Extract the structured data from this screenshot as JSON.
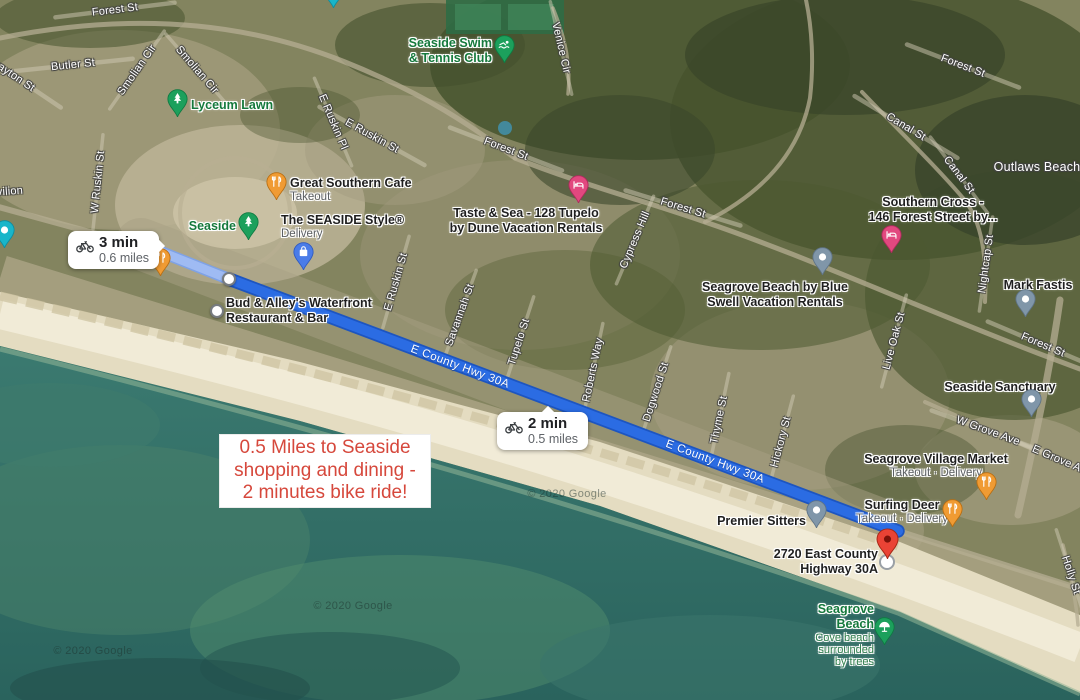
{
  "map": {
    "attribution": "© 2020 Google",
    "route": {
      "name": "E County Hwy 30A",
      "start": {
        "x": 141,
        "y": 244
      },
      "waypoint": {
        "x": 229,
        "y": 279
      },
      "end": {
        "x": 898,
        "y": 531
      },
      "labels": [
        {
          "x": 460,
          "y": 367,
          "rot": 20.5
        },
        {
          "x": 715,
          "y": 462,
          "rot": 20.5
        }
      ],
      "colors": {
        "selected": "#2B6CE3",
        "selected_casing": "#1D55C0",
        "segment": "#9FBBF3",
        "segment_casing": "#7FA2E5"
      }
    },
    "badges": [
      {
        "time": "3 min",
        "distance": "0.6 miles"
      },
      {
        "time": "2 min",
        "distance": "0.5 miles"
      }
    ],
    "annotation": {
      "lines": [
        "0.5 Miles to Seaside",
        "shopping and dining -",
        "2 minutes bike ride!"
      ]
    },
    "street_labels": [
      {
        "text": "Forest St",
        "x": 115,
        "y": 10,
        "rot": -7
      },
      {
        "text": "Butler St",
        "x": 73,
        "y": 65,
        "rot": -6
      },
      {
        "text": "Grayton St",
        "x": 11,
        "y": 74,
        "rot": 34
      },
      {
        "text": "Smolian Cir",
        "x": 137,
        "y": 70,
        "rot": -55
      },
      {
        "text": "Smolian Cir",
        "x": 197,
        "y": 70,
        "rot": 49
      },
      {
        "text": "W Ruskin St",
        "x": 98,
        "y": 182,
        "rot": -84
      },
      {
        "text": "E Ruskin Pl",
        "x": 333,
        "y": 122,
        "rot": 67
      },
      {
        "text": "E Ruskin St",
        "x": 372,
        "y": 136,
        "rot": 29
      },
      {
        "text": "E Ruskin St",
        "x": 396,
        "y": 282,
        "rot": -74
      },
      {
        "text": "Forest St",
        "x": 506,
        "y": 149,
        "rot": 21
      },
      {
        "text": "Venice Cir",
        "x": 561,
        "y": 48,
        "rot": 77
      },
      {
        "text": "Forest St",
        "x": 683,
        "y": 208,
        "rot": 17
      },
      {
        "text": "Cypress Hill",
        "x": 635,
        "y": 240,
        "rot": -67
      },
      {
        "text": "Forest St",
        "x": 963,
        "y": 66,
        "rot": 21
      },
      {
        "text": "Canal St",
        "x": 906,
        "y": 127,
        "rot": 31
      },
      {
        "text": "Canal St",
        "x": 959,
        "y": 175,
        "rot": 53
      },
      {
        "text": "Outlaws Beach",
        "x": 1037,
        "y": 167,
        "rot": 0,
        "size": 12.5,
        "noline": true
      },
      {
        "text": "Nightcap St",
        "x": 986,
        "y": 264,
        "rot": -82
      },
      {
        "text": "Live Oak St",
        "x": 894,
        "y": 341,
        "rot": -75
      },
      {
        "text": "Forest St",
        "x": 1043,
        "y": 345,
        "rot": 23
      },
      {
        "text": "Savannah St",
        "x": 460,
        "y": 315,
        "rot": -70
      },
      {
        "text": "Tupelo St",
        "x": 519,
        "y": 342,
        "rot": -72
      },
      {
        "text": "Roberts Way",
        "x": 593,
        "y": 370,
        "rot": -78
      },
      {
        "text": "Dogwood St",
        "x": 656,
        "y": 392,
        "rot": -72
      },
      {
        "text": "Thyme St",
        "x": 719,
        "y": 420,
        "rot": -78
      },
      {
        "text": "Hickory St",
        "x": 781,
        "y": 442,
        "rot": -75
      },
      {
        "text": "W Grove Ave",
        "x": 988,
        "y": 431,
        "rot": 20
      },
      {
        "text": "E Grove Ave",
        "x": 1062,
        "y": 461,
        "rot": 23
      },
      {
        "text": "Holly St",
        "x": 1071,
        "y": 575,
        "rot": 72
      },
      {
        "text": "Pavilion",
        "x": 3,
        "y": 192,
        "rot": -4,
        "noline": true
      }
    ],
    "poi_labels": [
      {
        "name": "lyceum-lawn",
        "type": "nature",
        "align": "left",
        "x": 191,
        "y": 96,
        "title_lines": [
          "Lyceum Lawn"
        ]
      },
      {
        "name": "seaside-swim-tennis-club",
        "type": "nature",
        "align": "right",
        "x": 492,
        "y": 36,
        "title_lines": [
          "Seaside Swim",
          "& Tennis Club"
        ]
      },
      {
        "name": "seaside",
        "type": "nature",
        "align": "right",
        "x": 236,
        "y": 217,
        "title_lines": [
          "Seaside"
        ]
      },
      {
        "name": "great-southern-cafe",
        "type": "business",
        "align": "left",
        "x": 290,
        "y": 176,
        "title_lines": [
          "Great Southern Cafe"
        ],
        "sub_lines": [
          "Takeout"
        ]
      },
      {
        "name": "the-seaside-style",
        "type": "business",
        "align": "left",
        "x": 281,
        "y": 213,
        "title_lines": [
          "The SEASIDE Style®"
        ],
        "sub_lines": [
          "Delivery"
        ]
      },
      {
        "name": "taste-and-sea",
        "type": "business",
        "align": "center",
        "x": 526,
        "y": 206,
        "title_lines": [
          "Taste & Sea - 128 Tupelo",
          "by Dune Vacation Rentals"
        ]
      },
      {
        "name": "bud-and-alleys",
        "type": "business",
        "align": "left",
        "x": 226,
        "y": 296,
        "title_lines": [
          "Bud & Alley's Waterfront",
          "Restaurant & Bar"
        ]
      },
      {
        "name": "southern-cross",
        "type": "business",
        "align": "center",
        "x": 933,
        "y": 195,
        "title_lines": [
          "Southern Cross -",
          "146 Forest Street by..."
        ]
      },
      {
        "name": "seagrove-by-blue-swell",
        "type": "business",
        "align": "center",
        "x": 775,
        "y": 280,
        "title_lines": [
          "Seagrove Beach by Blue",
          "Swell Vacation Rentals"
        ]
      },
      {
        "name": "mark-fastis",
        "type": "business",
        "align": "center",
        "x": 1038,
        "y": 276,
        "title_lines": [
          "Mark Fastis"
        ]
      },
      {
        "name": "seaside-sanctuary",
        "type": "business",
        "align": "center",
        "x": 1000,
        "y": 378,
        "title_lines": [
          "Seaside Sanctuary"
        ]
      },
      {
        "name": "seagrove-village-market",
        "type": "business",
        "align": "center",
        "x": 936,
        "y": 452,
        "title_lines": [
          "Seagrove Village Market"
        ],
        "sub_lines": [
          "Takeout · Delivery"
        ]
      },
      {
        "name": "surfing-deer",
        "type": "business",
        "align": "center",
        "x": 902,
        "y": 498,
        "title_lines": [
          "Surfing Deer"
        ],
        "sub_lines": [
          "Takeout · Delivery"
        ]
      },
      {
        "name": "premier-sitters",
        "type": "business",
        "align": "right",
        "x": 806,
        "y": 512,
        "title_lines": [
          "Premier Sitters"
        ]
      },
      {
        "name": "address-2720",
        "type": "business",
        "align": "right",
        "x": 878,
        "y": 547,
        "title_lines": [
          "2720 East County",
          "Highway 30A"
        ]
      },
      {
        "name": "seagrove-beach",
        "type": "nature",
        "align": "right",
        "x": 874,
        "y": 602,
        "title_lines": [
          "Seagrove",
          "Beach"
        ],
        "sub_lines": [
          "Cove beach",
          "surrounded",
          "by trees"
        ]
      }
    ],
    "pins": [
      {
        "name": "pin-route-start-restaurant",
        "type": "restaurant",
        "x": 160,
        "y": 276
      },
      {
        "name": "pin-great-southern-cafe",
        "type": "restaurant",
        "x": 276,
        "y": 200
      },
      {
        "name": "pin-lyceum-lawn",
        "type": "park",
        "x": 177,
        "y": 117
      },
      {
        "name": "pin-seaside",
        "type": "park",
        "x": 248,
        "y": 240
      },
      {
        "name": "pin-seaside-swim-tennis",
        "type": "swim",
        "x": 504,
        "y": 63
      },
      {
        "name": "pin-the-seaside-style",
        "type": "shopping",
        "x": 303,
        "y": 270
      },
      {
        "name": "pin-taste-and-sea",
        "type": "lodging",
        "x": 578,
        "y": 203
      },
      {
        "name": "pin-southern-cross",
        "type": "lodging",
        "x": 891,
        "y": 253
      },
      {
        "name": "pin-blue-swell",
        "type": "generic",
        "x": 822,
        "y": 275
      },
      {
        "name": "pin-mark-fastis",
        "type": "generic",
        "x": 1025,
        "y": 317
      },
      {
        "name": "pin-seaside-sanctuary",
        "type": "generic",
        "x": 1031,
        "y": 417
      },
      {
        "name": "pin-premier-sitters",
        "type": "generic",
        "x": 816,
        "y": 528
      },
      {
        "name": "pin-seagrove-village-market",
        "type": "restaurant",
        "x": 986,
        "y": 500
      },
      {
        "name": "pin-surfing-deer",
        "type": "restaurant",
        "x": 952,
        "y": 527
      },
      {
        "name": "pin-seagrove-beach",
        "type": "beach",
        "x": 884,
        "y": 645
      },
      {
        "name": "pin-top-edge",
        "type": "aqua",
        "x": 333,
        "y": 8
      },
      {
        "name": "pin-left-edge",
        "type": "aqua",
        "x": 4,
        "y": 248
      },
      {
        "name": "waypoint-dot",
        "type": "dot",
        "x": 229,
        "y": 279
      },
      {
        "name": "bud-and-alleys-dot",
        "type": "dot",
        "x": 217,
        "y": 311
      },
      {
        "name": "destination-ring",
        "type": "target",
        "x": 887,
        "y": 562
      },
      {
        "name": "pin-2720-destination",
        "type": "destination",
        "x": 887,
        "y": 559
      }
    ]
  }
}
